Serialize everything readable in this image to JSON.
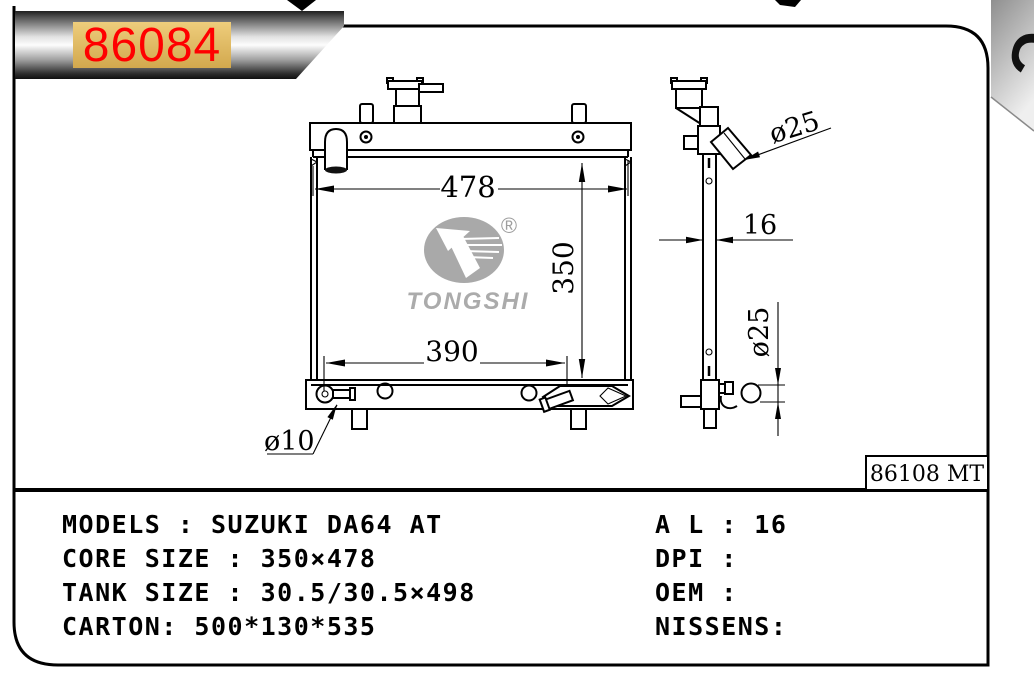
{
  "banner": {
    "part_number": "86084"
  },
  "corner_tab": {
    "letter": "C"
  },
  "drawing": {
    "front_view": {
      "width_dim": "478",
      "height_dim": "350",
      "lower_width_dim": "390",
      "drain_dim": "ø10"
    },
    "side_view": {
      "inlet_dim": "ø25",
      "thickness_dim": "16",
      "outlet_dim": "ø25"
    },
    "logo": {
      "brand": "TONGSHI",
      "registered_mark": "®"
    },
    "ref_code": "86108 MT"
  },
  "specs": {
    "left": [
      "MODELS : SUZUKI DA64 AT",
      "CORE SIZE : 350×478",
      "TANK SIZE : 30.5/30.5×498",
      "CARTON: 500*130*535"
    ],
    "right": [
      "A L : 16",
      "DPI :",
      "OEM :",
      "NISSENS:"
    ]
  },
  "colors": {
    "part_number_text": "#ff0000",
    "part_number_bg": "#e8c06a",
    "logo_gray": "#a9a9a9",
    "line": "#000000"
  }
}
